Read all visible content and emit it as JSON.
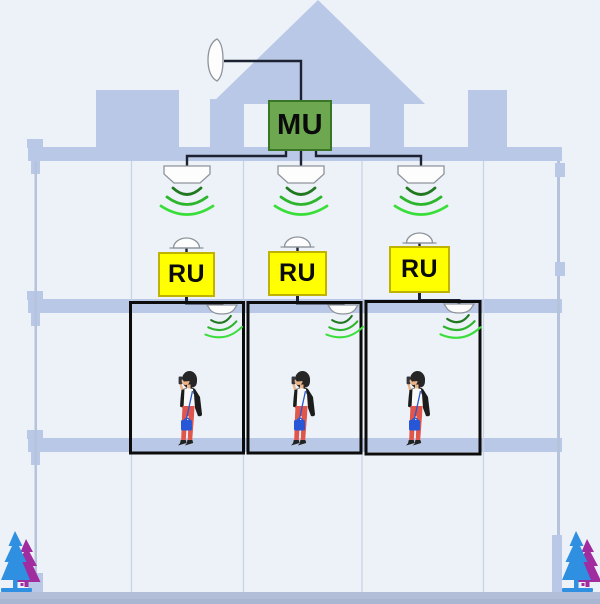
{
  "palette": {
    "bg": "#edf2f8",
    "facade": "#b9c8e6",
    "wall-line": "#c9d3e5",
    "edge-line": "#b6c3dc",
    "ground": "#b2bed8",
    "ground-dark": "#a9b6d2",
    "cable": "#1c2231",
    "mu-fill": "#6da850",
    "mu-border": "#387626",
    "ru-fill": "#ffff00",
    "ru-border": "#c0b200",
    "antenna-fill": "#fdfdfd",
    "antenna-stroke": "#8e949c",
    "wave-dark": "#217821",
    "wave-mid": "#2db52d",
    "wave-light": "#3ade3a",
    "room-border": "#0c0c0c",
    "tree-blue": "#2f8fe0",
    "tree-purple": "#a02ca0",
    "person-hair": "#262626",
    "person-skin": "#ecb489",
    "person-shirt": "#f8f8f8",
    "person-jacket": "#1c1c1c",
    "person-pants": "#e0564b",
    "person-bag": "#2757d6",
    "person-shoes": "#222222"
  },
  "units": {
    "master": {
      "label": "MU"
    },
    "remotes": [
      {
        "label": "RU"
      },
      {
        "label": "RU"
      },
      {
        "label": "RU"
      }
    ]
  },
  "icons": [
    "rooftop-dish-antenna-icon",
    "ceiling-antenna-icon",
    "wifi-waves-icon",
    "dome-antenna-icon",
    "indoor-antenna-icon",
    "person-with-phone-icon",
    "pine-trees-icon"
  ]
}
